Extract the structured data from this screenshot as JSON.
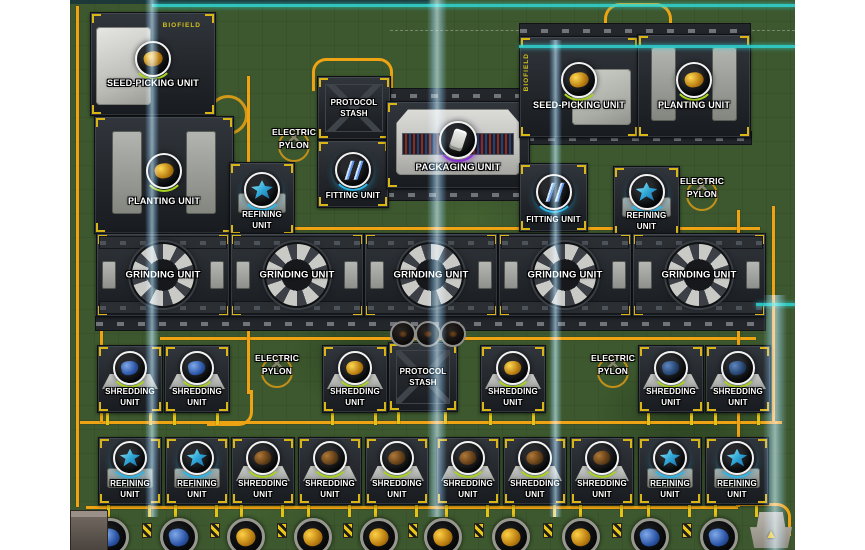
{
  "scene": {
    "type": "factory-automation-game-map",
    "terrain": "grass",
    "colors": {
      "terrain_green": "#3d582e",
      "conveyor_orange": "#eda313",
      "pipe_yellow": "#e3c219",
      "teal_boundary": "#2fd8d8",
      "power_beam_blue": "#7ec8ff",
      "panel_dark": "#24282d",
      "machine_light": "#c9cbc7",
      "label_text": "#ffffff",
      "bracket_yellow": "#d9b515",
      "glow_green": "#a8d420",
      "glow_cyan": "#2fb6e8",
      "glow_purple": "#8a2fd8",
      "item_gold": "#e8a81c",
      "item_blue": "#3f6fc2",
      "item_brown": "#8a5a28",
      "item_teal": "#3fc8e0"
    },
    "badge_text": "BIOFIELD"
  },
  "units": [
    {
      "type": "seed-picking",
      "x": 90,
      "y": 12,
      "w": 124,
      "h": 102,
      "lines": [
        "SEED-PICKING UNIT"
      ],
      "icon": {
        "kind": "gold",
        "cy": 44,
        "r": 16
      },
      "badge": "BIOFIELD",
      "variant": "left"
    },
    {
      "type": "planting",
      "x": 94,
      "y": 116,
      "w": 138,
      "h": 116,
      "lines": [
        "PLANTING UNIT"
      ],
      "icon": {
        "kind": "gold",
        "cy": 52,
        "r": 16
      }
    },
    {
      "type": "refining",
      "x": 229,
      "y": 162,
      "w": 64,
      "h": 72,
      "lines": [
        "REFINING",
        "UNIT"
      ],
      "icon": {
        "kind": "teal",
        "cy": 25,
        "r": 16
      }
    },
    {
      "type": "stash",
      "x": 317,
      "y": 76,
      "w": 72,
      "h": 62,
      "lines": [
        "PROTOCOL",
        "STASH"
      ]
    },
    {
      "type": "fitting",
      "x": 317,
      "y": 140,
      "w": 70,
      "h": 66,
      "lines": [
        "FITTING UNIT"
      ],
      "icon": {
        "kind": "slash",
        "cy": 27,
        "r": 16
      }
    },
    {
      "type": "packaging",
      "x": 386,
      "y": 101,
      "w": 142,
      "h": 86,
      "lines": [
        "PACKAGING UNIT"
      ],
      "icon": {
        "kind": "package",
        "cy": 36,
        "r": 17
      }
    },
    {
      "type": "seed-picking",
      "x": 519,
      "y": 36,
      "w": 118,
      "h": 100,
      "lines": [
        "SEED-PICKING UNIT"
      ],
      "icon": {
        "kind": "gold",
        "cy": 41,
        "r": 16
      },
      "badge": "BIOFIELD",
      "variant": "right"
    },
    {
      "type": "planting",
      "x": 637,
      "y": 34,
      "w": 112,
      "h": 102,
      "lines": [
        "PLANTING UNIT"
      ],
      "icon": {
        "kind": "gold",
        "cy": 43,
        "r": 16
      }
    },
    {
      "type": "fitting",
      "x": 519,
      "y": 163,
      "w": 67,
      "h": 67,
      "lines": [
        "FITTING UNIT"
      ],
      "icon": {
        "kind": "slash",
        "cy": 26,
        "r": 16
      }
    },
    {
      "type": "refining",
      "x": 613,
      "y": 166,
      "w": 65,
      "h": 69,
      "lines": [
        "REFINING",
        "UNIT"
      ],
      "icon": {
        "kind": "teal",
        "cy": 23,
        "r": 16
      }
    },
    {
      "type": "grinding",
      "x": 96,
      "y": 233,
      "w": 132,
      "h": 82,
      "lines": [
        "GRINDING UNIT"
      ]
    },
    {
      "type": "grinding",
      "x": 230,
      "y": 233,
      "w": 132,
      "h": 82,
      "lines": [
        "GRINDING UNIT"
      ]
    },
    {
      "type": "grinding",
      "x": 364,
      "y": 233,
      "w": 132,
      "h": 82,
      "lines": [
        "GRINDING UNIT"
      ]
    },
    {
      "type": "grinding",
      "x": 498,
      "y": 233,
      "w": 132,
      "h": 82,
      "lines": [
        "GRINDING UNIT"
      ]
    },
    {
      "type": "grinding",
      "x": 632,
      "y": 233,
      "w": 132,
      "h": 82,
      "lines": [
        "GRINDING UNIT"
      ]
    },
    {
      "type": "shredding",
      "x": 97,
      "y": 345,
      "w": 64,
      "h": 66,
      "lines": [
        "SHREDDING",
        "UNIT"
      ],
      "icon": {
        "kind": "blue",
        "cy": 20,
        "r": 15
      },
      "legs": true
    },
    {
      "type": "shredding",
      "x": 164,
      "y": 345,
      "w": 64,
      "h": 66,
      "lines": [
        "SHREDDING",
        "UNIT"
      ],
      "icon": {
        "kind": "blue",
        "cy": 20,
        "r": 15
      },
      "legs": true
    },
    {
      "type": "shredding",
      "x": 322,
      "y": 345,
      "w": 64,
      "h": 66,
      "lines": [
        "SHREDDING",
        "UNIT"
      ],
      "icon": {
        "kind": "gold",
        "cy": 20,
        "r": 15
      },
      "legs": true
    },
    {
      "type": "stash",
      "x": 388,
      "y": 342,
      "w": 68,
      "h": 68,
      "lines": [
        "PROTOCOL",
        "STASH"
      ],
      "legs": true
    },
    {
      "type": "shredding",
      "x": 480,
      "y": 345,
      "w": 64,
      "h": 66,
      "lines": [
        "SHREDDING",
        "UNIT"
      ],
      "icon": {
        "kind": "gold",
        "cy": 20,
        "r": 15
      },
      "legs": true
    },
    {
      "type": "shredding",
      "x": 638,
      "y": 345,
      "w": 64,
      "h": 66,
      "lines": [
        "SHREDDING",
        "UNIT"
      ],
      "icon": {
        "kind": "navy",
        "cy": 20,
        "r": 15
      },
      "legs": true
    },
    {
      "type": "shredding",
      "x": 705,
      "y": 345,
      "w": 64,
      "h": 66,
      "lines": [
        "SHREDDING",
        "UNIT"
      ],
      "icon": {
        "kind": "navy",
        "cy": 20,
        "r": 15
      },
      "legs": true
    },
    {
      "type": "refining",
      "x": 98,
      "y": 437,
      "w": 62,
      "h": 66,
      "lines": [
        "REFINING",
        "UNIT"
      ],
      "icon": {
        "kind": "teal",
        "cy": 18,
        "r": 15
      },
      "legs": true
    },
    {
      "type": "refining",
      "x": 165,
      "y": 437,
      "w": 62,
      "h": 66,
      "lines": [
        "REFINING",
        "UNIT"
      ],
      "icon": {
        "kind": "teal",
        "cy": 18,
        "r": 15
      },
      "legs": true
    },
    {
      "type": "shredding",
      "x": 231,
      "y": 437,
      "w": 62,
      "h": 66,
      "lines": [
        "SHREDDING",
        "UNIT"
      ],
      "icon": {
        "kind": "brown",
        "cy": 18,
        "r": 15
      },
      "legs": true
    },
    {
      "type": "shredding",
      "x": 298,
      "y": 437,
      "w": 62,
      "h": 66,
      "lines": [
        "SHREDDING",
        "UNIT"
      ],
      "icon": {
        "kind": "brown",
        "cy": 18,
        "r": 15
      },
      "legs": true
    },
    {
      "type": "shredding",
      "x": 365,
      "y": 437,
      "w": 62,
      "h": 66,
      "lines": [
        "SHREDDING",
        "UNIT"
      ],
      "icon": {
        "kind": "brown",
        "cy": 18,
        "r": 15
      },
      "legs": true
    },
    {
      "type": "shredding",
      "x": 436,
      "y": 437,
      "w": 62,
      "h": 66,
      "lines": [
        "SHREDDING",
        "UNIT"
      ],
      "icon": {
        "kind": "brown",
        "cy": 18,
        "r": 15
      },
      "legs": true
    },
    {
      "type": "shredding",
      "x": 503,
      "y": 437,
      "w": 62,
      "h": 66,
      "lines": [
        "SHREDDING",
        "UNIT"
      ],
      "icon": {
        "kind": "brown",
        "cy": 18,
        "r": 15
      },
      "legs": true
    },
    {
      "type": "shredding",
      "x": 570,
      "y": 437,
      "w": 62,
      "h": 66,
      "lines": [
        "SHREDDING",
        "UNIT"
      ],
      "icon": {
        "kind": "brown",
        "cy": 18,
        "r": 15
      },
      "legs": true
    },
    {
      "type": "refining",
      "x": 638,
      "y": 437,
      "w": 62,
      "h": 66,
      "lines": [
        "REFINING",
        "UNIT"
      ],
      "icon": {
        "kind": "teal",
        "cy": 18,
        "r": 15
      },
      "legs": true
    },
    {
      "type": "refining",
      "x": 705,
      "y": 437,
      "w": 62,
      "h": 66,
      "lines": [
        "REFINING",
        "UNIT"
      ],
      "icon": {
        "kind": "teal",
        "cy": 18,
        "r": 15
      },
      "legs": true
    }
  ],
  "pylons": [
    {
      "cx": 294,
      "cy": 126,
      "lines": [
        "ELECTRIC",
        "PYLON"
      ]
    },
    {
      "cx": 702,
      "cy": 175,
      "lines": [
        "ELECTRIC",
        "PYLON"
      ]
    },
    {
      "cx": 277,
      "cy": 352,
      "lines": [
        "ELECTRIC",
        "PYLON"
      ]
    },
    {
      "cx": 613,
      "cy": 352,
      "lines": [
        "ELECTRIC",
        "PYLON"
      ]
    }
  ],
  "rails": [
    {
      "x": 95,
      "y": 316,
      "w": 669,
      "h": 13
    },
    {
      "x": 388,
      "y": 88,
      "w": 140,
      "h": 12
    },
    {
      "x": 386,
      "y": 187,
      "w": 142,
      "h": 12
    },
    {
      "x": 519,
      "y": 23,
      "w": 230,
      "h": 12
    },
    {
      "x": 505,
      "y": 131,
      "w": 245,
      "h": 12
    }
  ],
  "paths": [
    {
      "k": "h",
      "x": 214,
      "y": 227,
      "l": 546
    },
    {
      "k": "h",
      "x": 160,
      "y": 337,
      "l": 596
    },
    {
      "k": "h",
      "x": 80,
      "y": 421,
      "l": 702
    },
    {
      "k": "h",
      "x": 86,
      "y": 506,
      "l": 652
    },
    {
      "k": "v",
      "x": 76,
      "y": 6,
      "l": 501
    },
    {
      "k": "v",
      "x": 100,
      "y": 232,
      "l": 190
    },
    {
      "k": "v",
      "x": 247,
      "y": 76,
      "l": 152
    },
    {
      "k": "v",
      "x": 247,
      "y": 234,
      "l": 160
    },
    {
      "k": "v",
      "x": 737,
      "y": 210,
      "l": 297
    },
    {
      "k": "v",
      "x": 772,
      "y": 206,
      "l": 216
    },
    {
      "k": "box",
      "cls": "b-tl",
      "x": 312,
      "y": 58,
      "w": 38,
      "h": 30
    },
    {
      "k": "box",
      "cls": "b-tr",
      "x": 350,
      "y": 58,
      "w": 40,
      "h": 30
    },
    {
      "k": "box",
      "cls": "arch",
      "x": 604,
      "y": 3,
      "w": 62,
      "h": 52
    },
    {
      "k": "box",
      "cls": "b-br",
      "x": 207,
      "y": 390,
      "w": 43,
      "h": 33
    },
    {
      "k": "box",
      "cls": "b-tr",
      "x": 736,
      "y": 503,
      "w": 52,
      "h": 30
    },
    {
      "k": "box",
      "cls": "ring",
      "x": 208,
      "y": 95,
      "w": 34,
      "h": 34
    }
  ],
  "beams": [
    {
      "x": 145,
      "y": 0,
      "w": 14,
      "h": 517
    },
    {
      "x": 427,
      "y": 0,
      "w": 20,
      "h": 517
    },
    {
      "x": 549,
      "y": 40,
      "w": 13,
      "h": 477
    },
    {
      "x": 763,
      "y": 295,
      "w": 24,
      "h": 255
    }
  ],
  "teal_lines": [
    {
      "x": 152,
      "y": 4,
      "w": 643
    },
    {
      "x": 519,
      "y": 45,
      "w": 276
    },
    {
      "x": 756,
      "y": 303,
      "w": 39
    }
  ],
  "dash_lines": [
    {
      "x": 390,
      "y": 30,
      "w": 405
    }
  ],
  "dark_top": {
    "x": 70,
    "y": 0,
    "w": 360,
    "h": 4
  },
  "loose_items": [
    {
      "x": 401,
      "y": 332
    },
    {
      "x": 426,
      "y": 332
    },
    {
      "x": 451,
      "y": 332
    }
  ],
  "belt": {
    "y": 517,
    "h": 33,
    "items": [
      {
        "x": 107,
        "c": "blue"
      },
      {
        "x": 176,
        "c": "blue"
      },
      {
        "x": 243,
        "c": "gold"
      },
      {
        "x": 310,
        "c": "gold"
      },
      {
        "x": 376,
        "c": "gold"
      },
      {
        "x": 440,
        "c": "gold"
      },
      {
        "x": 508,
        "c": "gold"
      },
      {
        "x": 578,
        "c": "gold"
      },
      {
        "x": 647,
        "c": "blue"
      },
      {
        "x": 716,
        "c": "blue"
      }
    ],
    "ticks": [
      142,
      210,
      277,
      343,
      408,
      474,
      543,
      612,
      682
    ],
    "stub": {
      "x": 70,
      "y": 510,
      "w": 36,
      "h": 40
    },
    "hazard": {
      "x": 750,
      "y": 512,
      "w": 42,
      "h": 36,
      "glyph": "▲"
    }
  }
}
